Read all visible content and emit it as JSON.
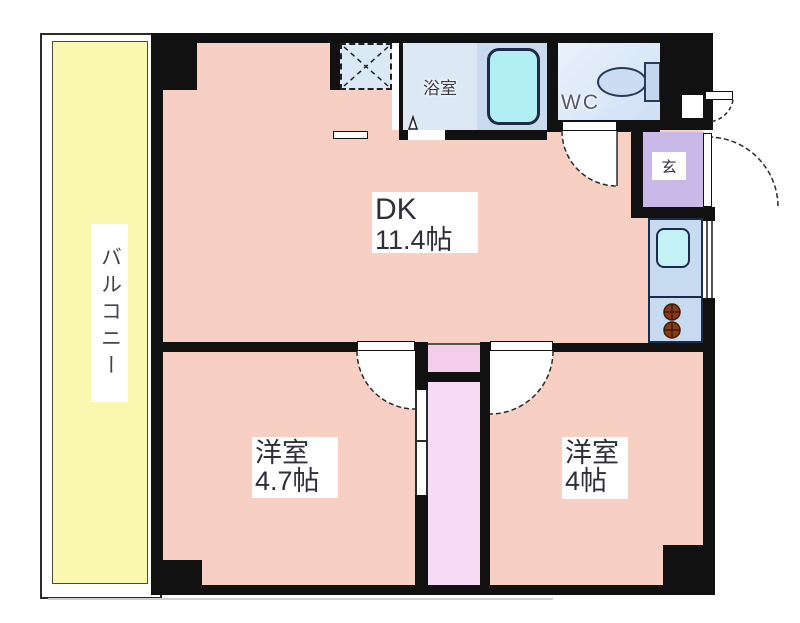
{
  "floorplan": {
    "title": "2DK間取り図",
    "rooms": {
      "balcony": {
        "label": "バルコニー"
      },
      "dk": {
        "label": "DK",
        "size": "11.4帖"
      },
      "bedroom1": {
        "label": "洋室",
        "size": "4.7帖"
      },
      "bedroom2": {
        "label": "洋室",
        "size": "4帖"
      },
      "bathroom": {
        "label": "浴室"
      },
      "wc": {
        "label": "WC"
      },
      "entrance": {
        "label": "玄"
      }
    },
    "fixtures": [
      "bathtub-icon",
      "toilet-icon",
      "kitchen-sink-icon",
      "stove-burners-icon",
      "washing-machine-space-icon",
      "door-swing-arcs",
      "sliding-door"
    ],
    "colors": {
      "room_pink": "#F8CFC3",
      "balcony_yellow": "#FAF8B0",
      "closet_pink": "#F8DBF4",
      "entrance_purple": "#C9B8E8",
      "bath_blue": "#DCE9F5",
      "tub_cyan": "#B2EFF4",
      "counter_blue": "#C6DBF0",
      "wall_black": "#111111",
      "burner_brown": "#8A3A12"
    }
  }
}
